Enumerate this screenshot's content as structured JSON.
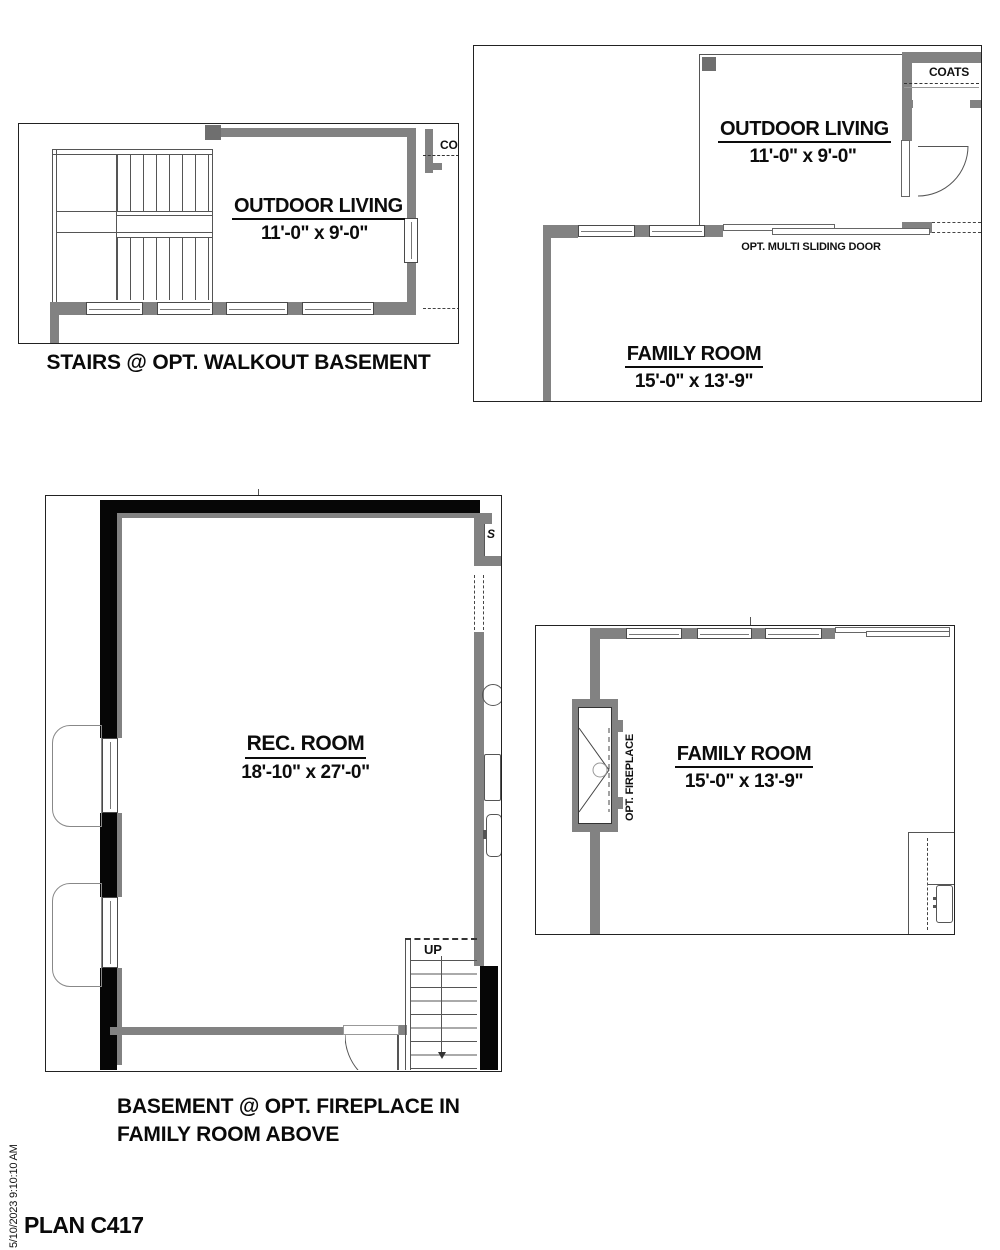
{
  "title_block": {
    "plan_number": "PLAN C417",
    "timestamp": "5/10/2023 9:10:10 AM"
  },
  "plans": {
    "walkout": {
      "caption": "STAIRS @ OPT. WALKOUT BASEMENT",
      "outdoor_living": {
        "name": "OUTDOOR LIVING",
        "dims": "11'-0\" x 9'-0\""
      },
      "partial_coats_label": "CO"
    },
    "main_level": {
      "outdoor_living": {
        "name": "OUTDOOR LIVING",
        "dims": "11'-0\" x 9'-0\""
      },
      "family_room": {
        "name": "FAMILY ROOM",
        "dims": "15'-0\" x 13'-9\""
      },
      "coats_label": "COATS",
      "sliding_door_note": "OPT. MULTI SLIDING DOOR"
    },
    "basement": {
      "caption_line1": "BASEMENT @ OPT. FIREPLACE IN",
      "caption_line2": "FAMILY ROOM ABOVE",
      "rec_room": {
        "name": "REC. ROOM",
        "dims": "18'-10\" x 27'-0\""
      },
      "stairs_label": "UP",
      "partial_label": "S"
    },
    "family_room_option": {
      "family_room": {
        "name": "FAMILY ROOM",
        "dims": "15'-0\" x 13'-9\""
      },
      "fireplace_note": "OPT. FIREPLACE"
    }
  }
}
